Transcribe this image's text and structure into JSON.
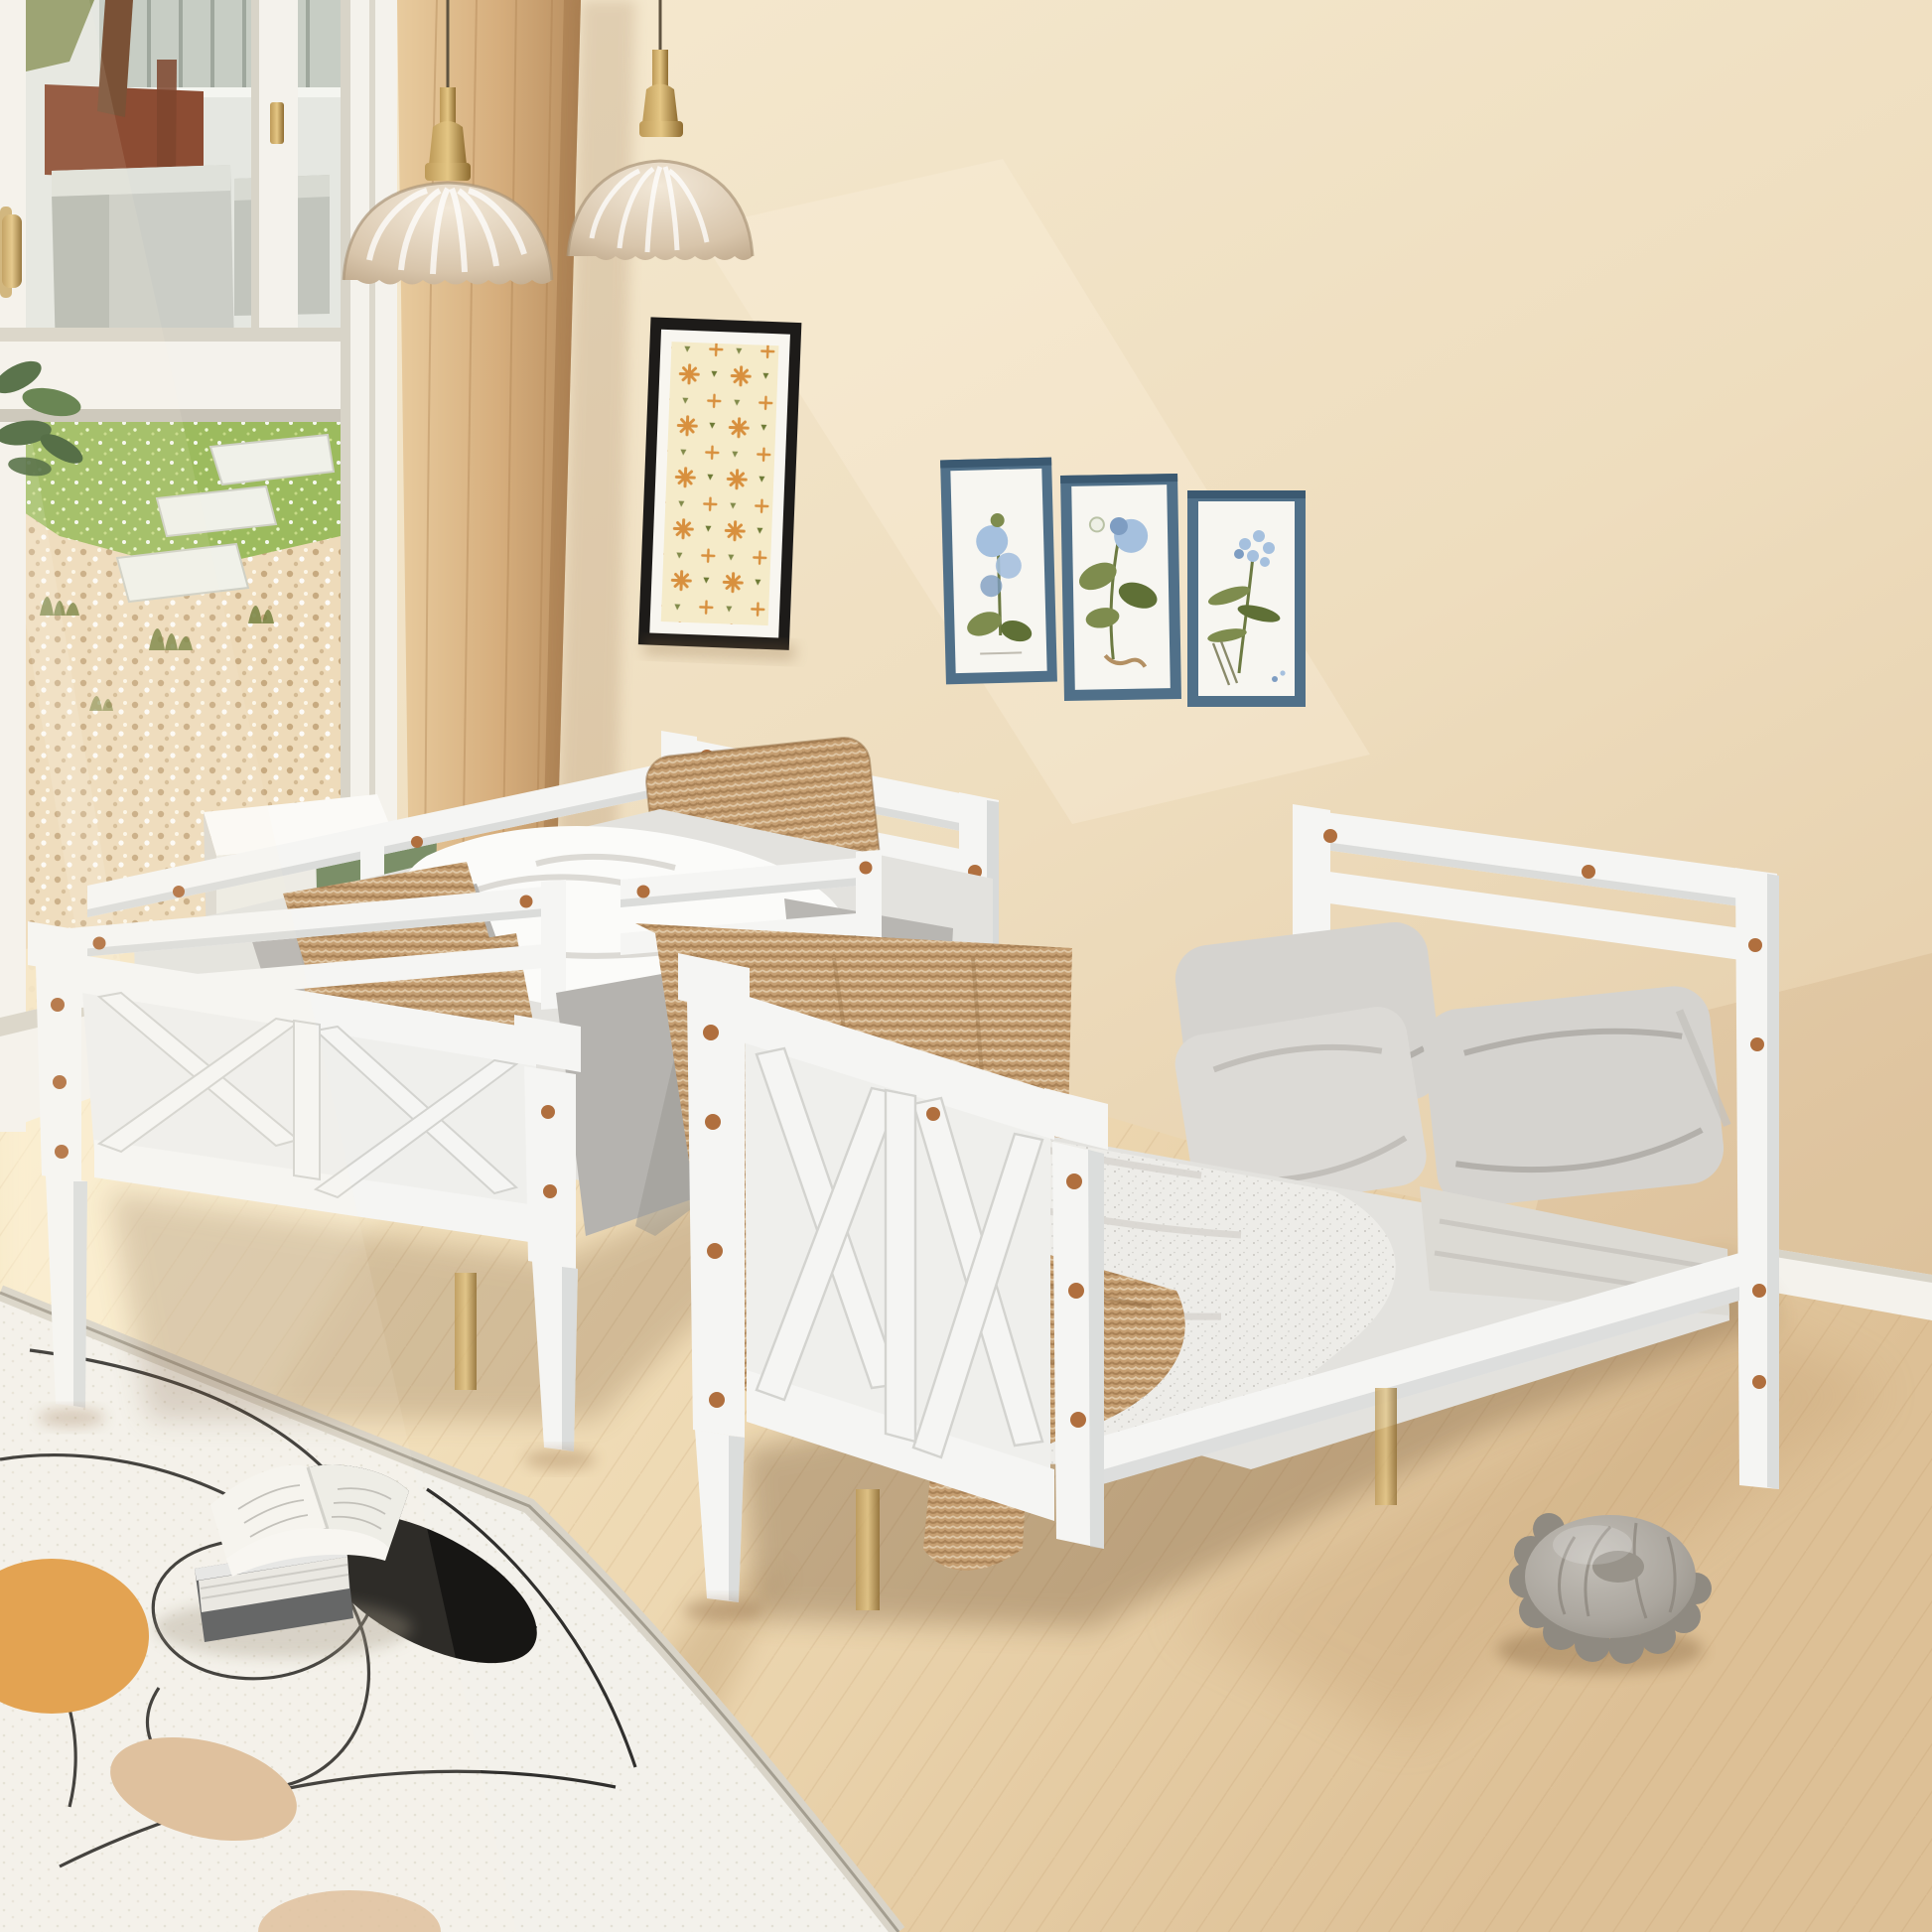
{
  "scene": {
    "label": "Bedroom product photo: two white wood beds (twin bed with guardrails and full platform bed) with X-brace panels, beige wall, glass door to garden, two glass pendant lamps, framed prints, abstract rug with open book, grey pom-pom floor pouf",
    "objects": [
      "glass-door-garden-view",
      "wood-wall-panel",
      "pendant-lamp",
      "pendant-lamp",
      "black-framed-pattern-art",
      "blue-framed-botanical-print",
      "blue-framed-botanical-print",
      "blue-framed-botanical-print",
      "twin-guardrail-bed",
      "white-nightstand",
      "green-cushion",
      "knit-pillow",
      "knit-throw",
      "full-platform-bed",
      "grey-pillows",
      "melange-blanket",
      "tan-throw",
      "abstract-area-rug",
      "open-book",
      "closed-book",
      "pompom-pouf",
      "baseboard"
    ]
  },
  "palette": {
    "wall_top": "#f6ebd2",
    "wall_mid": "#eeddbe",
    "wall_low": "#e2c9a4",
    "wall_dark": "#d3b58d",
    "floor_light": "#f8ebca",
    "floor_mid": "#eed9b3",
    "floor_dark": "#ddc096",
    "floor_deep": "#caa87c",
    "wood_light": "#e8cb9e",
    "wood_mid": "#d6ae7d",
    "wood_dark": "#b98f60",
    "frame_white": "#f4f2ec",
    "frame_shadow": "#d8d4c8",
    "glass_hi": "#edefe9",
    "building": "#e5e7e1",
    "building_dark": "#a9b1a7",
    "balcony": "#c7cdc4",
    "fence": "#8c4c33",
    "trunk": "#7a5136",
    "grass": "#9cbb5e",
    "grass_light": "#d0e18f",
    "gravel": "#eedbba",
    "gravel_dot": "#bd9e72",
    "stone": "#f0f1e9",
    "shrub": "#76813f",
    "sand": "#f5e7c6",
    "plant_green": "#49663b",
    "bed_white": "#f5f5f3",
    "bed_shadow": "#dbdcda",
    "bed_dark": "#c5c8c8",
    "copper": "#b06f3e",
    "knit": "#c59e71",
    "knit_dark": "#a57d50",
    "duvet": "#fbfbf9",
    "duvet_shadow": "#dcdbd7",
    "gray_fabric": "#b5b3af",
    "gray_fabric_dark": "#999792",
    "pillow_gray": "#d5d3cf",
    "pillow_gray_dark": "#bcb9b4",
    "melange": "#edece8",
    "sheet": "#e3e2de",
    "green_cushion": "#7b8f68",
    "rug": "#f3f1eb",
    "rug_edge": "#d9d4c8",
    "rug_orange": "#e09a42",
    "rug_black": "#171614",
    "rug_tan": "#dcbb97",
    "book_cover": "#55575a",
    "book_pages": "#f5f4f0",
    "book_lines": "#b7b5b0",
    "pouf": "#aba69e",
    "pouf_dark": "#8f8a81",
    "pouf_light": "#c3bfb8",
    "frame_black": "#1d1b19",
    "mat": "#f8f6f0",
    "art_cream": "#f5ebc9",
    "art_orange": "#d8903e",
    "art_green": "#6d7a35",
    "frame_blue": "#507089",
    "frame_blue_dark": "#3b5971",
    "print_bg": "#f7f6f1",
    "leaf": "#7e8c4e",
    "leaf_dark": "#5f7036",
    "flower_blue": "#a5c0de",
    "flower_blue_dark": "#7e9dc2",
    "brass": "#bd9a58",
    "brass_dark": "#8e6c30",
    "cord": "#5f5340",
    "metal": "#c3c7cb",
    "metal_dark": "#8f959b"
  }
}
